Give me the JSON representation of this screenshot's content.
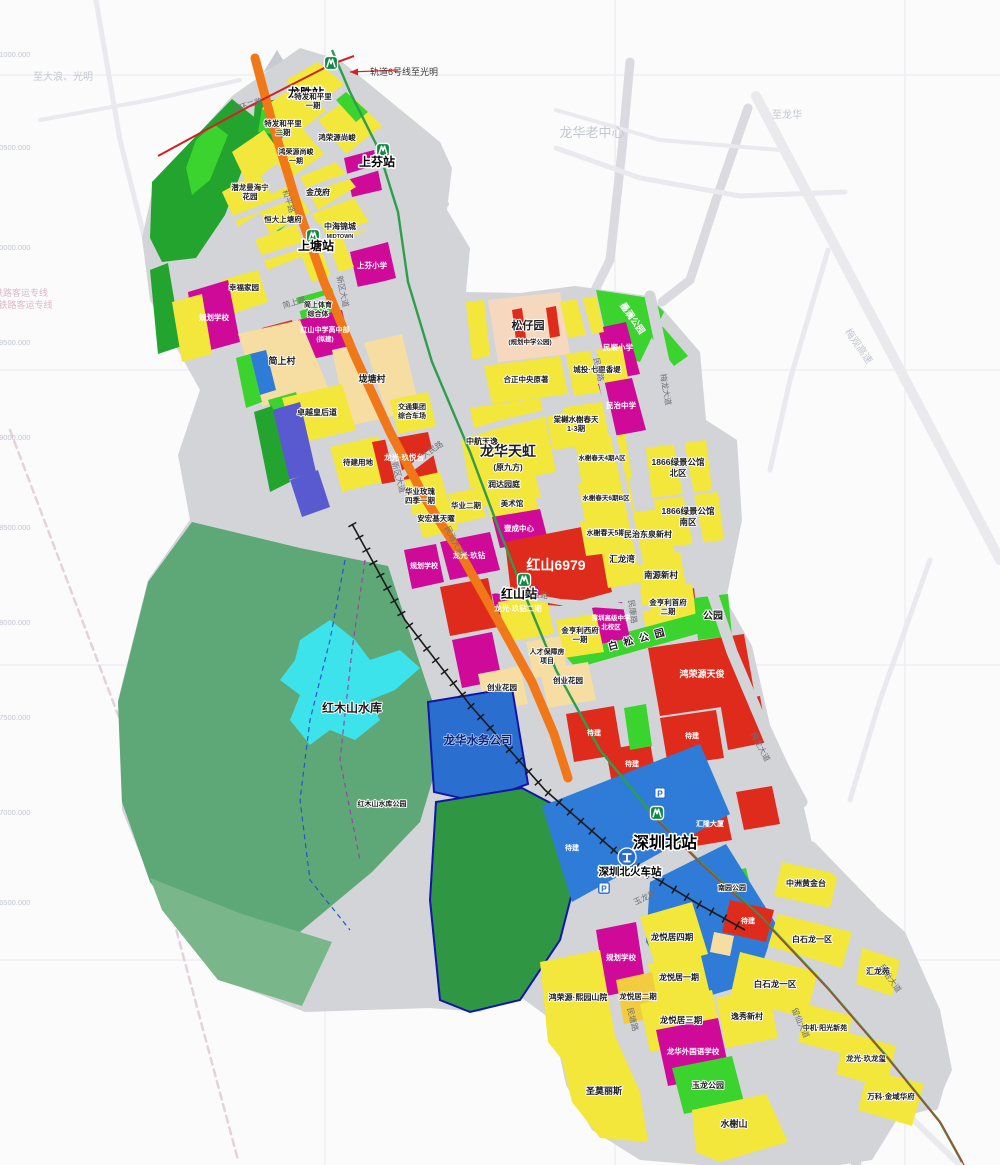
{
  "map": {
    "title": "龙华深圳北站片区规划图",
    "colors": {
      "residential_yellow": "#F2E73A",
      "village_cream": "#F6DEA2",
      "school_magenta": "#CF0A99",
      "commercial_red": "#DF2B1C",
      "park_green": "#3BD32D",
      "dark_green": "#22A42F",
      "forest_green": "#5EA877",
      "water_cyan": "#3DE3EA",
      "station_blue": "#2F7CD8",
      "utility_blue": "#2A6FD0",
      "road_orange": "#F07818",
      "road_grey": "#D2D4D8",
      "metro_green_line": "#2E9E4A",
      "line6_red": "#D42020"
    },
    "annotation": {
      "line6_note": "轨道6号线至光明"
    },
    "icons": {
      "parking_label": "P",
      "metro": [
        [
          331,
          63
        ],
        [
          383,
          150
        ],
        [
          313,
          236
        ],
        [
          524,
          580
        ],
        [
          657,
          813
        ]
      ],
      "rail_emblem": [
        [
          627,
          857
        ]
      ],
      "parking": [
        [
          660,
          793
        ],
        [
          604,
          888
        ]
      ]
    },
    "labels": [
      {
        "t": "龙华老中心",
        "x": 592,
        "y": 137,
        "s": 13,
        "st": "faint"
      },
      {
        "t": "至大浪、光明",
        "x": 63,
        "y": 80,
        "s": 10,
        "st": "faint"
      },
      {
        "t": "至龙华",
        "x": 787,
        "y": 118,
        "s": 10,
        "st": "faint"
      },
      {
        "t": "梅观高速",
        "x": 856,
        "y": 348,
        "s": 10,
        "st": "faint",
        "r": 55
      },
      {
        "t": "广深铁路客运专线",
        "x": 12,
        "y": 296,
        "s": 9,
        "st": "faintpink",
        "a": "s"
      },
      {
        "t": "广深港铁路客运专线",
        "x": 12,
        "y": 308,
        "s": 9,
        "st": "faintpink",
        "a": "s"
      },
      {
        "t": "X=41000.000",
        "x": 8,
        "y": 57,
        "s": 7.5,
        "st": "faint",
        "a": "s"
      },
      {
        "t": "X=40500.000",
        "x": 8,
        "y": 150,
        "s": 7.5,
        "st": "faint",
        "a": "s"
      },
      {
        "t": "X=40000.000",
        "x": 8,
        "y": 250,
        "s": 7.5,
        "st": "faint",
        "a": "s"
      },
      {
        "t": "X=39500.000",
        "x": 8,
        "y": 345,
        "s": 7.5,
        "st": "faint",
        "a": "s"
      },
      {
        "t": "X=39000.000",
        "x": 8,
        "y": 440,
        "s": 7.5,
        "st": "faint",
        "a": "s"
      },
      {
        "t": "X=38500.000",
        "x": 8,
        "y": 530,
        "s": 7.5,
        "st": "faint",
        "a": "s"
      },
      {
        "t": "X=38000.000",
        "x": 8,
        "y": 625,
        "s": 7.5,
        "st": "faint",
        "a": "s"
      },
      {
        "t": "X=37500.000",
        "x": 8,
        "y": 720,
        "s": 7.5,
        "st": "faint",
        "a": "s"
      },
      {
        "t": "X=37000.000",
        "x": 8,
        "y": 815,
        "s": 7.5,
        "st": "faint",
        "a": "s"
      },
      {
        "t": "X=36500.000",
        "x": 8,
        "y": 905,
        "s": 7.5,
        "st": "faint",
        "a": "s"
      },
      {
        "t": "轨道6号线至光明",
        "x": 404,
        "y": 75,
        "s": 9,
        "st": "anno",
        "a": "s"
      },
      {
        "t": "龙胜站",
        "x": 306,
        "y": 97,
        "s": 12,
        "st": "station"
      },
      {
        "t": "上芬站",
        "x": 377,
        "y": 166,
        "s": 12,
        "st": "station"
      },
      {
        "t": "上塘站",
        "x": 316,
        "y": 250,
        "s": 12,
        "st": "station"
      },
      {
        "t": "红山站",
        "x": 519,
        "y": 598,
        "s": 12,
        "st": "station"
      },
      {
        "t": "深圳北站",
        "x": 665,
        "y": 848,
        "s": 16,
        "st": "station"
      },
      {
        "t": "深圳北火车站",
        "x": 630,
        "y": 875,
        "s": 10.5,
        "st": "station"
      },
      {
        "t": "特发和平里",
        "x": 313,
        "y": 99,
        "s": 7.5,
        "st": "place"
      },
      {
        "t": "一期",
        "x": 313,
        "y": 108,
        "s": 7.5,
        "st": "place"
      },
      {
        "t": "特发和平里",
        "x": 283,
        "y": 126,
        "s": 7.5,
        "st": "place"
      },
      {
        "t": "二期",
        "x": 283,
        "y": 135,
        "s": 7.5,
        "st": "place"
      },
      {
        "t": "鸿荣源尚峻",
        "x": 337,
        "y": 140,
        "s": 7.5,
        "st": "place"
      },
      {
        "t": "鸿荣源尚峻",
        "x": 296,
        "y": 154,
        "s": 7,
        "st": "place"
      },
      {
        "t": "一期",
        "x": 296,
        "y": 163,
        "s": 7,
        "st": "place"
      },
      {
        "t": "潜龙曼海宁",
        "x": 250,
        "y": 190,
        "s": 7.5,
        "st": "place"
      },
      {
        "t": "花园",
        "x": 250,
        "y": 199,
        "s": 7.5,
        "st": "place"
      },
      {
        "t": "金茂府",
        "x": 318,
        "y": 195,
        "s": 8,
        "st": "place"
      },
      {
        "t": "恒大上塘府",
        "x": 283,
        "y": 222,
        "s": 7.5,
        "st": "place"
      },
      {
        "t": "中海锦城",
        "x": 340,
        "y": 229,
        "s": 8,
        "st": "place"
      },
      {
        "t": "MIDTOWN",
        "x": 340,
        "y": 238,
        "s": 5.5,
        "st": "place"
      },
      {
        "t": "上芬小学",
        "x": 372,
        "y": 268,
        "s": 7.5,
        "st": "white"
      },
      {
        "t": "幸福家园",
        "x": 244,
        "y": 290,
        "s": 7.5,
        "st": "place"
      },
      {
        "t": "规划学校",
        "x": 214,
        "y": 320,
        "s": 7.5,
        "st": "white"
      },
      {
        "t": "简上体育",
        "x": 318,
        "y": 307,
        "s": 7,
        "st": "place"
      },
      {
        "t": "综合体",
        "x": 318,
        "y": 316,
        "s": 7,
        "st": "place"
      },
      {
        "t": "红山中学高中部",
        "x": 325,
        "y": 332,
        "s": 7,
        "st": "white"
      },
      {
        "t": "(拟建)",
        "x": 325,
        "y": 341,
        "s": 6.5,
        "st": "white"
      },
      {
        "t": "简上村",
        "x": 282,
        "y": 364,
        "s": 9,
        "st": "place"
      },
      {
        "t": "垅塘村",
        "x": 372,
        "y": 382,
        "s": 9,
        "st": "place"
      },
      {
        "t": "卓越皇后道",
        "x": 317,
        "y": 415,
        "s": 8,
        "st": "place"
      },
      {
        "t": "待建用地",
        "x": 358,
        "y": 465,
        "s": 7.5,
        "st": "place"
      },
      {
        "t": "交通集团",
        "x": 412,
        "y": 409,
        "s": 7,
        "st": "place"
      },
      {
        "t": "综合车场",
        "x": 412,
        "y": 418,
        "s": 7,
        "st": "place"
      },
      {
        "t": "龙光·玖悦台",
        "x": 404,
        "y": 460,
        "s": 7.5,
        "st": "white"
      },
      {
        "t": "华业玫瑰",
        "x": 420,
        "y": 494,
        "s": 7.5,
        "st": "place"
      },
      {
        "t": "四季一期",
        "x": 420,
        "y": 503,
        "s": 7.5,
        "st": "place"
      },
      {
        "t": "安宏基天曜",
        "x": 436,
        "y": 521,
        "s": 7.5,
        "st": "place"
      },
      {
        "t": "华业二期",
        "x": 466,
        "y": 508,
        "s": 7.5,
        "st": "place"
      },
      {
        "t": "中航天逸",
        "x": 482,
        "y": 444,
        "s": 8,
        "st": "place"
      },
      {
        "t": "龙华天虹",
        "x": 508,
        "y": 456,
        "s": 14,
        "st": "bold"
      },
      {
        "t": "(原九方)",
        "x": 508,
        "y": 470,
        "s": 8,
        "st": "place"
      },
      {
        "t": "润达园庭",
        "x": 504,
        "y": 487,
        "s": 8,
        "st": "place"
      },
      {
        "t": "美术馆",
        "x": 512,
        "y": 506,
        "s": 7.5,
        "st": "place"
      },
      {
        "t": "壹成中心",
        "x": 519,
        "y": 531,
        "s": 7.5,
        "st": "white"
      },
      {
        "t": "龙光·玖钻",
        "x": 469,
        "y": 558,
        "s": 7.5,
        "st": "white"
      },
      {
        "t": "规划学校",
        "x": 424,
        "y": 568,
        "s": 7,
        "st": "white"
      },
      {
        "t": "红山6979",
        "x": 556,
        "y": 570,
        "s": 14,
        "st": "boldwhite"
      },
      {
        "t": "龙光·玖钻二期",
        "x": 518,
        "y": 611,
        "s": 7.5,
        "st": "white"
      },
      {
        "t": "松仔园",
        "x": 528,
        "y": 329,
        "s": 11,
        "st": "bold"
      },
      {
        "t": "(规划中学公园)",
        "x": 530,
        "y": 344,
        "s": 6.5,
        "st": "place"
      },
      {
        "t": "合正中央原著",
        "x": 526,
        "y": 382,
        "s": 7.5,
        "st": "place"
      },
      {
        "t": "城投·七里香堤",
        "x": 597,
        "y": 372,
        "s": 7.5,
        "st": "place"
      },
      {
        "t": "棠樾水榭春天",
        "x": 576,
        "y": 422,
        "s": 7.5,
        "st": "place"
      },
      {
        "t": "1-3期",
        "x": 576,
        "y": 431,
        "s": 7.5,
        "st": "place"
      },
      {
        "t": "民顺小学",
        "x": 618,
        "y": 350,
        "s": 7.5,
        "st": "white"
      },
      {
        "t": "民治中学",
        "x": 621,
        "y": 408,
        "s": 7.5,
        "st": "white"
      },
      {
        "t": "墨澜公园",
        "x": 630,
        "y": 320,
        "s": 9,
        "st": "white",
        "r": 55
      },
      {
        "t": "水榭春天4期A区",
        "x": 602,
        "y": 460,
        "s": 6.5,
        "st": "place"
      },
      {
        "t": "水榭春天6期B区",
        "x": 606,
        "y": 500,
        "s": 6.5,
        "st": "place"
      },
      {
        "t": "1866绿景公馆",
        "x": 678,
        "y": 465,
        "s": 8.5,
        "st": "place"
      },
      {
        "t": "北区",
        "x": 678,
        "y": 476,
        "s": 8.5,
        "st": "place"
      },
      {
        "t": "1866绿景公馆",
        "x": 688,
        "y": 514,
        "s": 8.5,
        "st": "place"
      },
      {
        "t": "南区",
        "x": 688,
        "y": 525,
        "s": 8.5,
        "st": "place"
      },
      {
        "t": "水榭春天5期",
        "x": 606,
        "y": 535,
        "s": 7,
        "st": "place"
      },
      {
        "t": "民治东泉新村",
        "x": 648,
        "y": 537,
        "s": 8,
        "st": "place"
      },
      {
        "t": "汇龙湾",
        "x": 622,
        "y": 562,
        "s": 8.5,
        "st": "place"
      },
      {
        "t": "南源新村",
        "x": 661,
        "y": 578,
        "s": 8.5,
        "st": "place"
      },
      {
        "t": "金亨利首府",
        "x": 668,
        "y": 605,
        "s": 7.5,
        "st": "place"
      },
      {
        "t": "二期",
        "x": 668,
        "y": 614,
        "s": 7.5,
        "st": "place"
      },
      {
        "t": "公园",
        "x": 713,
        "y": 619,
        "s": 10,
        "st": "place"
      },
      {
        "t": "白松公园",
        "x": 640,
        "y": 642,
        "s": 10,
        "st": "place",
        "r": -15,
        "ls": 6
      },
      {
        "t": "深圳高级中学",
        "x": 611,
        "y": 620,
        "s": 6.5,
        "st": "white"
      },
      {
        "t": "北校区",
        "x": 611,
        "y": 629,
        "s": 6.5,
        "st": "white"
      },
      {
        "t": "金亨利西府",
        "x": 580,
        "y": 633,
        "s": 7.5,
        "st": "place"
      },
      {
        "t": "一期",
        "x": 580,
        "y": 642,
        "s": 7.5,
        "st": "place"
      },
      {
        "t": "人才保障房",
        "x": 547,
        "y": 654,
        "s": 7,
        "st": "place"
      },
      {
        "t": "项目",
        "x": 547,
        "y": 663,
        "s": 7,
        "st": "place"
      },
      {
        "t": "创业花园",
        "x": 502,
        "y": 690,
        "s": 7.5,
        "st": "place"
      },
      {
        "t": "创业花园",
        "x": 568,
        "y": 683,
        "s": 7.5,
        "st": "place"
      },
      {
        "t": "鸿荣源天俊",
        "x": 702,
        "y": 677,
        "s": 9,
        "st": "white"
      },
      {
        "t": "待建",
        "x": 594,
        "y": 735,
        "s": 7,
        "st": "white"
      },
      {
        "t": "待建",
        "x": 632,
        "y": 766,
        "s": 7,
        "st": "white"
      },
      {
        "t": "待建",
        "x": 692,
        "y": 738,
        "s": 7,
        "st": "white"
      },
      {
        "t": "待建",
        "x": 572,
        "y": 850,
        "s": 7,
        "st": "white"
      },
      {
        "t": "汇隆大厦",
        "x": 710,
        "y": 826,
        "s": 7,
        "st": "white"
      },
      {
        "t": "红木山水库",
        "x": 352,
        "y": 712,
        "s": 12,
        "st": "bold"
      },
      {
        "t": "红木山水库公园",
        "x": 382,
        "y": 806,
        "s": 7,
        "st": "place"
      },
      {
        "t": "龙华水务公司",
        "x": 478,
        "y": 744,
        "s": 11.5,
        "st": "navy"
      },
      {
        "t": "南园公园",
        "x": 732,
        "y": 890,
        "s": 7,
        "st": "place"
      },
      {
        "t": "中洲黄金台",
        "x": 806,
        "y": 886,
        "s": 8,
        "st": "place"
      },
      {
        "t": "待建",
        "x": 748,
        "y": 923,
        "s": 7,
        "st": "white"
      },
      {
        "t": "白石龙一区",
        "x": 812,
        "y": 942,
        "s": 8,
        "st": "place"
      },
      {
        "t": "白石龙一区",
        "x": 775,
        "y": 987,
        "s": 8.5,
        "st": "place"
      },
      {
        "t": "汇龙苑",
        "x": 878,
        "y": 974,
        "s": 8,
        "st": "place"
      },
      {
        "t": "中机·阳光新苑",
        "x": 825,
        "y": 1030,
        "s": 7,
        "st": "place"
      },
      {
        "t": "龙光·玖龙玺",
        "x": 866,
        "y": 1061,
        "s": 7.5,
        "st": "place"
      },
      {
        "t": "万科·金域华府",
        "x": 891,
        "y": 1099,
        "s": 7.5,
        "st": "place"
      },
      {
        "t": "规划学校",
        "x": 621,
        "y": 960,
        "s": 7.5,
        "st": "white"
      },
      {
        "t": "龙悦居四期",
        "x": 672,
        "y": 940,
        "s": 8.5,
        "st": "place"
      },
      {
        "t": "龙悦居一期",
        "x": 679,
        "y": 980,
        "s": 8,
        "st": "place"
      },
      {
        "t": "龙悦居二期",
        "x": 638,
        "y": 999,
        "s": 7.5,
        "st": "place"
      },
      {
        "t": "龙悦居三期",
        "x": 681,
        "y": 1023,
        "s": 8.5,
        "st": "place"
      },
      {
        "t": "鸿荣源·熙园山院",
        "x": 578,
        "y": 1000,
        "s": 8,
        "st": "place"
      },
      {
        "t": "逸秀新村",
        "x": 747,
        "y": 1019,
        "s": 8,
        "st": "place"
      },
      {
        "t": "龙华外国语学校",
        "x": 693,
        "y": 1054,
        "s": 7.5,
        "st": "white"
      },
      {
        "t": "玉龙公园",
        "x": 708,
        "y": 1088,
        "s": 8,
        "st": "place"
      },
      {
        "t": "圣莫丽斯",
        "x": 604,
        "y": 1094,
        "s": 9,
        "st": "place"
      },
      {
        "t": "水榭山",
        "x": 734,
        "y": 1127,
        "s": 9,
        "st": "place"
      },
      {
        "t": "新区大道",
        "x": 340,
        "y": 292,
        "s": 8,
        "st": "road",
        "r": 78
      },
      {
        "t": "新区大道",
        "x": 396,
        "y": 478,
        "s": 8,
        "st": "road",
        "r": 75
      },
      {
        "t": "简上路",
        "x": 295,
        "y": 305,
        "s": 8,
        "st": "road",
        "r": -17
      },
      {
        "t": "人民路",
        "x": 434,
        "y": 452,
        "s": 8,
        "st": "road",
        "r": -35
      },
      {
        "t": "和平路",
        "x": 286,
        "y": 202,
        "s": 8,
        "st": "road",
        "r": 72
      },
      {
        "t": "民治大道",
        "x": 452,
        "y": 542,
        "s": 8,
        "st": "road",
        "r": 62
      },
      {
        "t": "民康路",
        "x": 596,
        "y": 370,
        "s": 8,
        "st": "road",
        "r": 78
      },
      {
        "t": "梅龙大道",
        "x": 663,
        "y": 390,
        "s": 8,
        "st": "road",
        "r": 80
      },
      {
        "t": "梅龙大道",
        "x": 758,
        "y": 748,
        "s": 8,
        "st": "road",
        "r": 62
      },
      {
        "t": "民宝路",
        "x": 536,
        "y": 597,
        "s": 8,
        "st": "road",
        "r": 8
      },
      {
        "t": "玉龙路",
        "x": 646,
        "y": 900,
        "s": 8,
        "st": "road",
        "r": -25
      },
      {
        "t": "留仙大道",
        "x": 798,
        "y": 1024,
        "s": 8,
        "st": "road",
        "r": 66
      },
      {
        "t": "东环二路",
        "x": 248,
        "y": 108,
        "s": 8,
        "st": "road",
        "r": -18
      },
      {
        "t": "民康路",
        "x": 630,
        "y": 612,
        "s": 8,
        "st": "road",
        "r": 82
      },
      {
        "t": "民塘路",
        "x": 630,
        "y": 1020,
        "s": 8,
        "st": "road",
        "r": 76
      },
      {
        "t": "民治大道",
        "x": 888,
        "y": 980,
        "s": 8,
        "st": "road",
        "r": 55
      }
    ]
  }
}
